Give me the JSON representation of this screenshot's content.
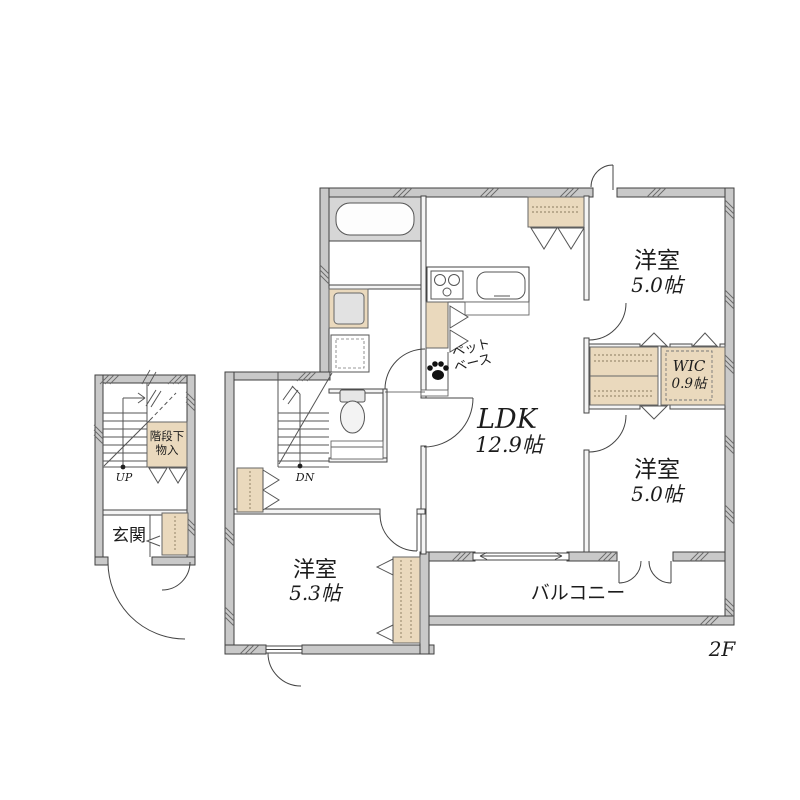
{
  "floor_plan": {
    "floor_label": "2F",
    "rooms": {
      "ldk": {
        "name": "LDK",
        "size": "12.9帖"
      },
      "bedroom_ne": {
        "name": "洋室",
        "size": "5.0帖"
      },
      "bedroom_se": {
        "name": "洋室",
        "size": "5.0帖"
      },
      "bedroom_sw": {
        "name": "洋室",
        "size": "5.3帖"
      },
      "wic": {
        "name": "WIC",
        "size": "0.9帖"
      },
      "balcony": {
        "name": "バルコニー"
      },
      "entrance": {
        "name": "玄関"
      },
      "pet_base": {
        "line1": "ペット",
        "line2": "ベース"
      },
      "under_stair_storage": {
        "line1": "階段下",
        "line2": "物入"
      }
    },
    "stairs": {
      "up": "UP",
      "down": "DN"
    },
    "colors": {
      "wall": "#c9c9c9",
      "closet_fill": "#ead9bd",
      "tub_surround": "#d6d6d6",
      "line": "#3f3f3f"
    }
  }
}
